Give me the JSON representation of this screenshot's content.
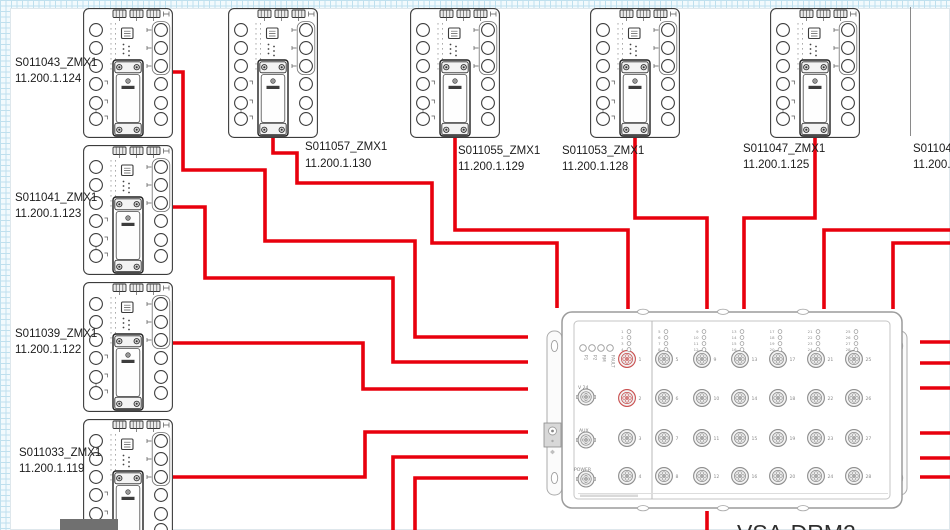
{
  "diagram": {
    "hub": {
      "name": "VSA-DRM2",
      "status_leds": [
        "P1",
        "P2",
        "RM",
        "FAULT"
      ],
      "side_connectors": [
        "V 24",
        "AUX",
        "POWER"
      ],
      "highlighted_ports": [
        1,
        2
      ],
      "port_columns": [
        [
          "1",
          "2",
          "3",
          "4"
        ],
        [
          "5",
          "6",
          "7",
          "8"
        ],
        [
          "9",
          "10",
          "11",
          "12"
        ],
        [
          "13",
          "14",
          "15",
          "16"
        ],
        [
          "17",
          "18",
          "19",
          "20"
        ],
        [
          "21",
          "22",
          "23",
          "24"
        ],
        [
          "25",
          "26",
          "27",
          "28"
        ]
      ]
    },
    "left_devices": [
      {
        "name": "S011043_ZMX1",
        "ip": "11.200.1.124"
      },
      {
        "name": "S011041_ZMX1",
        "ip": "11.200.1.123"
      },
      {
        "name": "S011039_ZMX1",
        "ip": "11.200.1.122"
      },
      {
        "name": "S011033_ZMX1",
        "ip": "11.200.1.119"
      }
    ],
    "top_devices": [
      {
        "name": "S011057_ZMX1",
        "ip": "11.200.1.130"
      },
      {
        "name": "S011055_ZMX1",
        "ip": "11.200.1.129"
      },
      {
        "name": "S011053_ZMX1",
        "ip": "11.200.1.128"
      },
      {
        "name": "S011047_ZMX1",
        "ip": "11.200.1.125"
      },
      {
        "name": "S011049",
        "ip": "11.200.1"
      }
    ],
    "colors": {
      "wire": "#e8000d",
      "highlight_port": "#c94f4f",
      "module_stroke": "#3c3c3c",
      "hub_stroke": "#9c9c9c",
      "label_text": "#1c1c1c"
    }
  }
}
